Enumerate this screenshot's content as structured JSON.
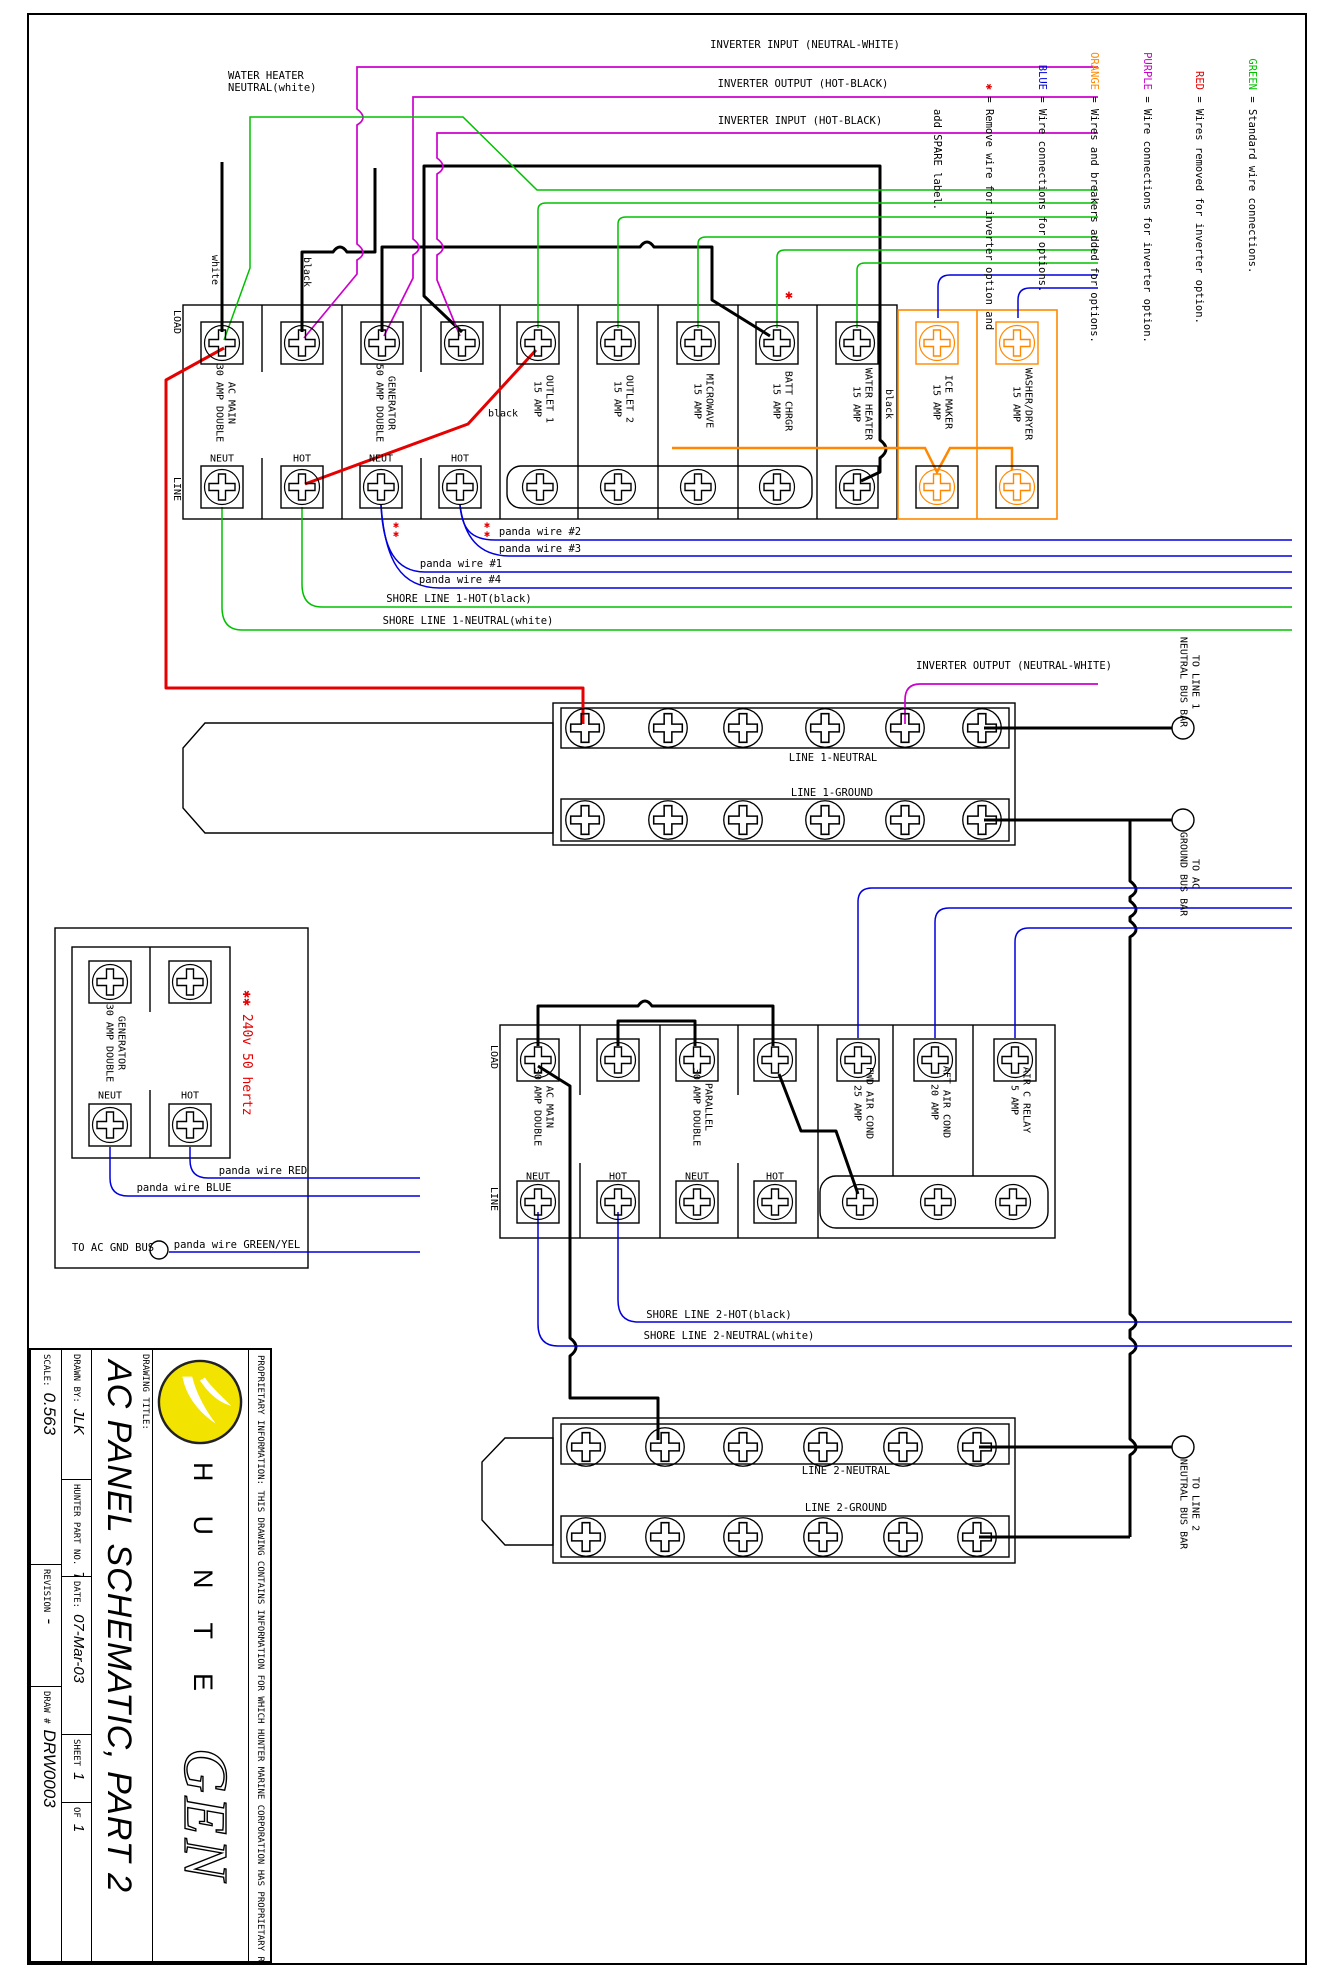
{
  "colors": {
    "green": "#00c000",
    "red": "#e60000",
    "purple": "#cc00cc",
    "orange": "#ff8800",
    "blue": "#0000dd",
    "logo_yellow": "#f3e300"
  },
  "legend": {
    "lines": [
      {
        "key": "GREEN",
        "desc": " = Standard wire connections."
      },
      {
        "key": "RED",
        "desc": " = Wires removed for inverter option."
      },
      {
        "key": "PURPLE",
        "desc": " = Wire connections for inverter option."
      },
      {
        "key": "ORANGE",
        "desc": " = Wires and breakers added for options."
      },
      {
        "key": "BLUE",
        "desc": " = Wire connections for options."
      },
      {
        "key": "✱",
        "desc": " = Remove wire for inverter option and"
      },
      {
        "key": "",
        "desc": "   add SPARE label."
      }
    ]
  },
  "top_labels": {
    "inverter_input_nw": "INVERTER INPUT (NEUTRAL-WHITE)",
    "inverter_output_hb": "INVERTER OUTPUT (HOT-BLACK)",
    "inverter_input_hb": "INVERTER INPUT (HOT-BLACK)",
    "water_heater_neutral": "WATER HEATER\nNEUTRAL(white)",
    "white": "white",
    "black": "black"
  },
  "top_panel": {
    "load": "LOAD",
    "line": "LINE",
    "neut": "NEUT",
    "hot": "HOT",
    "breakers": [
      "AC MAIN\n30 AMP DOUBLE",
      "GENERATOR\n50 AMP DOUBLE",
      "OUTLET 1\n15 AMP",
      "OUTLET 2\n15 AMP",
      "MICROWAVE\n15 AMP",
      "BATT CHRGR\n15 AMP",
      "WATER HEATER\n15 AMP",
      "ICE MAKER\n15 AMP",
      "WASHER/DRYER\n15 AMP"
    ]
  },
  "wires": {
    "panda2": "panda wire #2",
    "panda3": "panda wire #3",
    "panda1": "panda wire #1",
    "panda4": "panda wire #4",
    "shore1_hot": "SHORE LINE 1-HOT(black)",
    "shore1_neutral": "SHORE LINE 1-NEUTRAL(white)",
    "inverter_output_nw": "INVERTER OUTPUT (NEUTRAL-WHITE)",
    "shore2_hot": "SHORE LINE 2-HOT(black)",
    "shore2_neutral": "SHORE LINE 2-NEUTRAL(white)"
  },
  "bus1": {
    "neutral": "LINE 1-NEUTRAL",
    "ground": "LINE 1-GROUND",
    "to_neutral": "TO LINE 1\nNEUTRAL BUS BAR",
    "to_ground": "TO AC\nGROUND BUS BAR"
  },
  "bus2": {
    "neutral": "LINE 2-NEUTRAL",
    "ground": "LINE 2-GROUND",
    "to_neutral": "TO LINE 2\nNEUTRAL BUS BAR"
  },
  "gen_panel": {
    "breaker": "GENERATOR\n30 AMP DOUBLE",
    "neut": "NEUT",
    "hot": "HOT",
    "note": "✱✱ 240v 50 hertz",
    "panda_red": "panda wire RED",
    "panda_blue": "panda wire BLUE",
    "panda_gy": "panda wire GREEN/YEL",
    "to_gnd": "TO AC GND BUS"
  },
  "lower_panel": {
    "load": "LOAD",
    "line": "LINE",
    "neut": "NEUT",
    "hot": "HOT",
    "breakers": [
      "AC MAIN\n30 AMP DOUBLE",
      "PARALLEL\n30 AMP DOUBLE",
      "FWD AIR COND\n25 AMP",
      "AFT AIR COND\n20 AMP",
      "AIR C RELAY\n5 AMP"
    ]
  },
  "marks": {
    "spare": "✱",
    "double_star": "✱\n✱"
  },
  "title_block": {
    "proprietary": "PROPRIETARY INFORMATION: THIS DRAWING CONTAINS INFORMATION FOR WHICH HUNTER MARINE CORPORATION HAS PROPRIETARY RIGHTS.",
    "logo_letters": "HUNTE",
    "logo_big": "GEN",
    "drawing_title_label": "DRAWING TITLE:",
    "title": "AC PANEL SCHEMATIC, PART 2",
    "drawn_by_label": "DRAWN BY:",
    "drawn_by": "JLK",
    "part_label": "HUNTER PART NO.",
    "part": "TBD",
    "date_label": "DATE:",
    "date": "07-Mar-03",
    "sheet_label": "SHEET",
    "sheet": "1",
    "of_label": "OF",
    "of": "1",
    "scale_label": "SCALE:",
    "scale": "0.563",
    "revision_label": "REVISION",
    "revision": "-",
    "draw_label": "DRAW #",
    "draw_no": "DRW0003"
  }
}
